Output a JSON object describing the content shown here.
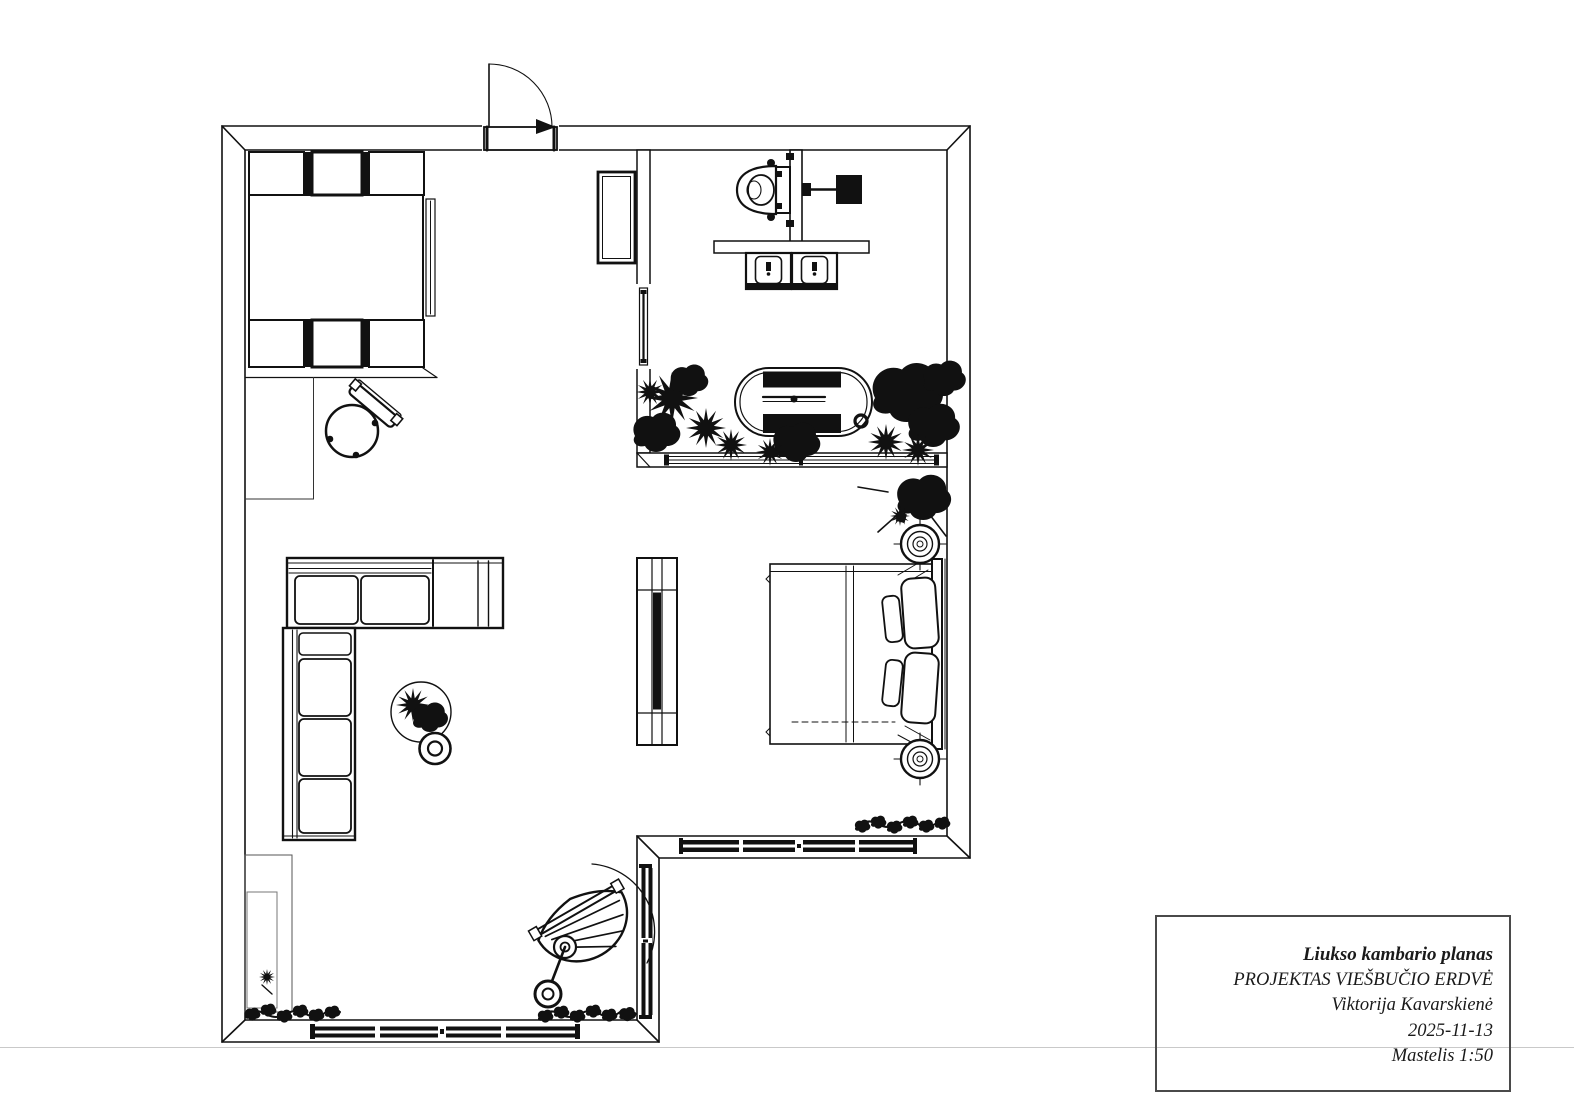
{
  "title_block": {
    "project_title": "Liukso kambario planas",
    "project_subtitle": "PROJEKTAS VIEŠBUČIO ERDVĖ",
    "author": "Viktorija Kavarskienė",
    "date": "2025-11-13",
    "scale": "Mastelis 1:50"
  },
  "colors": {
    "line": "#111111",
    "background": "#ffffff",
    "page_line": "#c9c9c9",
    "title_border": "#4a4a4a"
  },
  "plan": {
    "drawing_type": "hotel suite floor plan, black-and-white CAD line drawing",
    "symbols": [
      "entry-door-with-swing-arc",
      "wardrobe-with-compartments",
      "desk-nook",
      "round-desk-chair",
      "wall-cabinet",
      "pocket-door",
      "wall-hung-toilet",
      "shower-head",
      "double-sink-vanity",
      "oval-bathtub",
      "plant-silhouettes",
      "glazed-window-bands",
      "tv-partition",
      "double-bed-with-pillows",
      "bedside-lamp-circles",
      "l-shaped-sectional-sofa",
      "round-coffee-table-with-plant",
      "hanging-egg-chair",
      "mirror-alcove",
      "vine-garlands"
    ]
  }
}
